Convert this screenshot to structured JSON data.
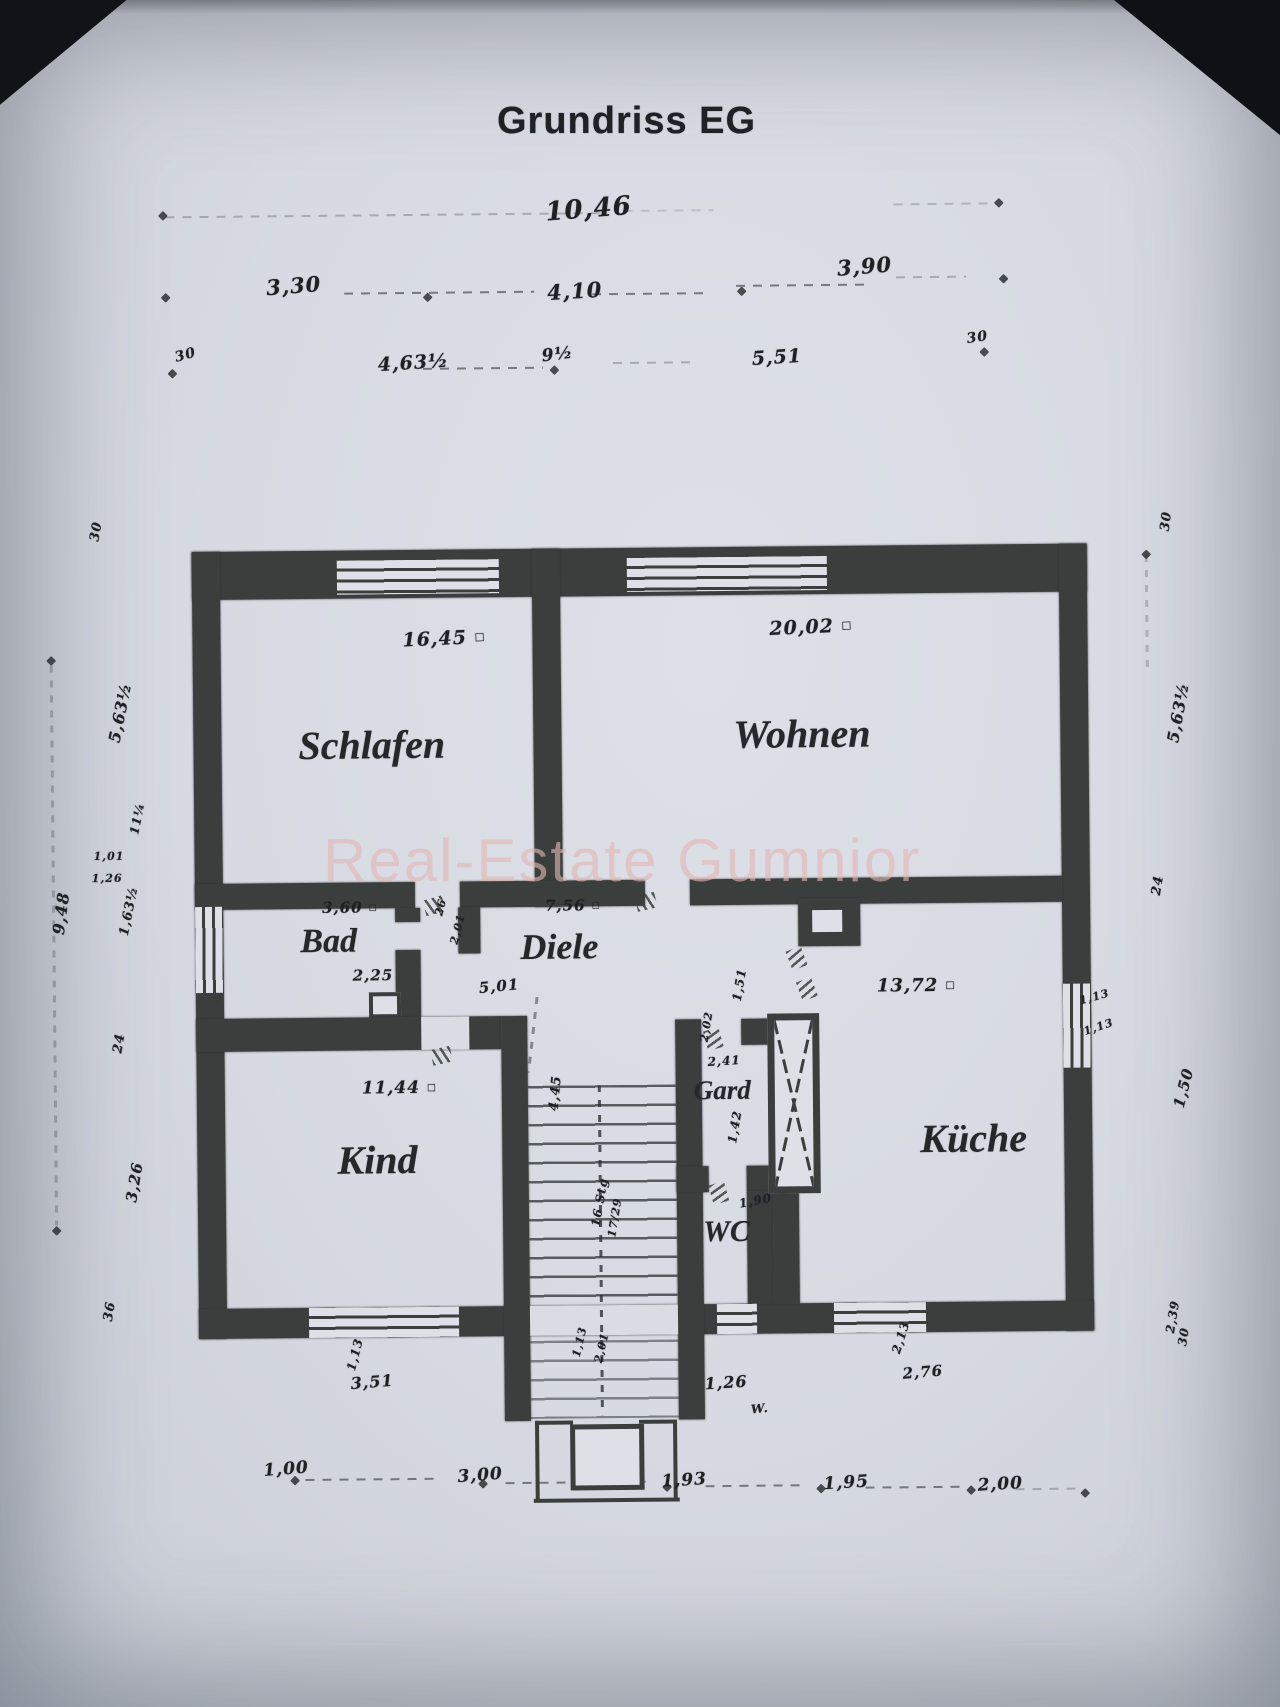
{
  "title": "Grundriss EG",
  "watermark": "Real-Estate Gumnior",
  "sq": "□",
  "rooms": {
    "schlafen": {
      "name": "Schlafen",
      "area": "16,45"
    },
    "wohnen": {
      "name": "Wohnen",
      "area": "20,02"
    },
    "bad": {
      "name": "Bad",
      "area": "3,60",
      "width": "2,25"
    },
    "diele": {
      "name": "Diele",
      "area": "7,56",
      "width": "5,01"
    },
    "kueche": {
      "name": "Küche",
      "area": "13,72"
    },
    "kind": {
      "name": "Kind",
      "area": "11,44"
    },
    "gard": {
      "name": "Gard",
      "depth": "2,41",
      "width": "1,42"
    },
    "wc": {
      "name": "WC",
      "width": "1,90"
    }
  },
  "dims_top": {
    "total": "10,46",
    "a": "3,30",
    "b": "4,10",
    "c": "3,90",
    "d": "30",
    "e": "4,63½",
    "f": "9½",
    "g": "5,51",
    "h": "30"
  },
  "dims_left": {
    "a": "30",
    "b": "5,63½",
    "c": "9,48",
    "d": "11¼",
    "e": "1,63½",
    "f": "1,01",
    "g": "1,26",
    "h": "24",
    "i": "3,26",
    "j": "36"
  },
  "dims_right": {
    "a": "30",
    "b": "5,63½",
    "c": "24",
    "d": "1,13",
    "e": "1,13",
    "f": "1,50",
    "g": "2,39",
    "h": "30"
  },
  "dims_bottom": {
    "a": "1,13",
    "b": "3,51",
    "c": "1,26",
    "d": "W.",
    "e": "2,13",
    "f": "2,76",
    "g": "1,00",
    "h": "3,00",
    "i": "1,93",
    "j": "1,95",
    "k": "2,00"
  },
  "marks": {
    "a": "26",
    "b": "2,01",
    "c": "1,51",
    "d": "2,02"
  },
  "stairs": {
    "height": "4,45",
    "steps": "16 Stg",
    "ratio": "17/29",
    "a": "1,13",
    "b": "2,01"
  }
}
